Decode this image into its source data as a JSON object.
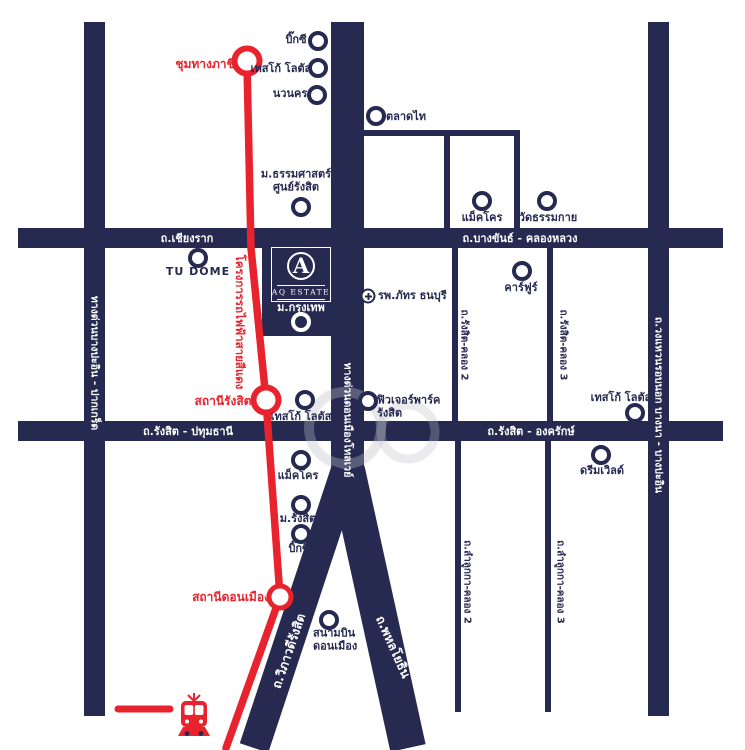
{
  "colors": {
    "navy": "#262a50",
    "red": "#e8232e",
    "background": "#ffffff"
  },
  "logo": {
    "monogram": "A",
    "name": "AQ ESTATE"
  },
  "legend": {
    "railway_icon": "train-front",
    "railway_color": "#e8232e"
  },
  "red_line": {
    "project_label": "โครงการรถไฟฟ้าสายสีแดง",
    "stations": [
      {
        "name": "ชุมทางภาชี"
      },
      {
        "name": "สถานีรังสิต"
      },
      {
        "name": "สถานีดอนเมือง"
      }
    ]
  },
  "roads": {
    "chiang_rak": "ถ.เชียงราก",
    "bang_khan": "ถ.บางขันธ์ - คลองหลวง",
    "rangsit_pathum": "ถ.รังสิต - ปทุมธานี",
    "rangsit_ongkharak": "ถ.รังสิต - องครักษ์",
    "expressway_left": "ทางด่วนบางปะอิน - ปากเกร็ด",
    "tollway": "ทางด่วนดอนเมืองโทลเวย์",
    "outer_ring": "ถ.วงแหวนรอบนอก บางนา - บางปะอิน",
    "vibhavadi": "ถ.วิภาวดีรังสิต",
    "phahonyothin": "ถ.พหลโยธิน",
    "rangsit_khlong2": "ถ.รังสิต-คลอง 2",
    "rangsit_khlong3": "ถ.รังสิต-คลอง 3",
    "lamlukka_khlong2": "ถ.ลำลูกกา-คลอง 2",
    "lamlukka_khlong3": "ถ.ลำลูกกา-คลอง 3"
  },
  "pois": [
    {
      "label": "บิ๊กซี"
    },
    {
      "label": "เทสโก้ โลตัส"
    },
    {
      "label": "นวนคร"
    },
    {
      "label": "ตลาดไท"
    },
    {
      "line1": "ม.ธรรมศาสตร์",
      "line2": "ศูนย์รังสิต"
    },
    {
      "label": "แม็คโคร"
    },
    {
      "label": "วัดธรรมกาย"
    },
    {
      "label": "TU DOME"
    },
    {
      "label": "คาร์ฟูร์"
    },
    {
      "label": "ม.กรุงเทพ"
    },
    {
      "label": "รพ.ภัทร ธนบุรี"
    },
    {
      "label": "เทสโก้ โลตัส"
    },
    {
      "line1": "ฟิวเจอร์พาร์ค",
      "line2": "รังสิต"
    },
    {
      "label": "เทสโก้ โลตัส"
    },
    {
      "label": "ดรีมเวิลด์"
    },
    {
      "label": "แม็คโคร"
    },
    {
      "label": "ม.รังสิต"
    },
    {
      "label": "บิ๊กซี"
    },
    {
      "line1": "สนามบิน",
      "line2": "ดอนเมือง"
    }
  ]
}
